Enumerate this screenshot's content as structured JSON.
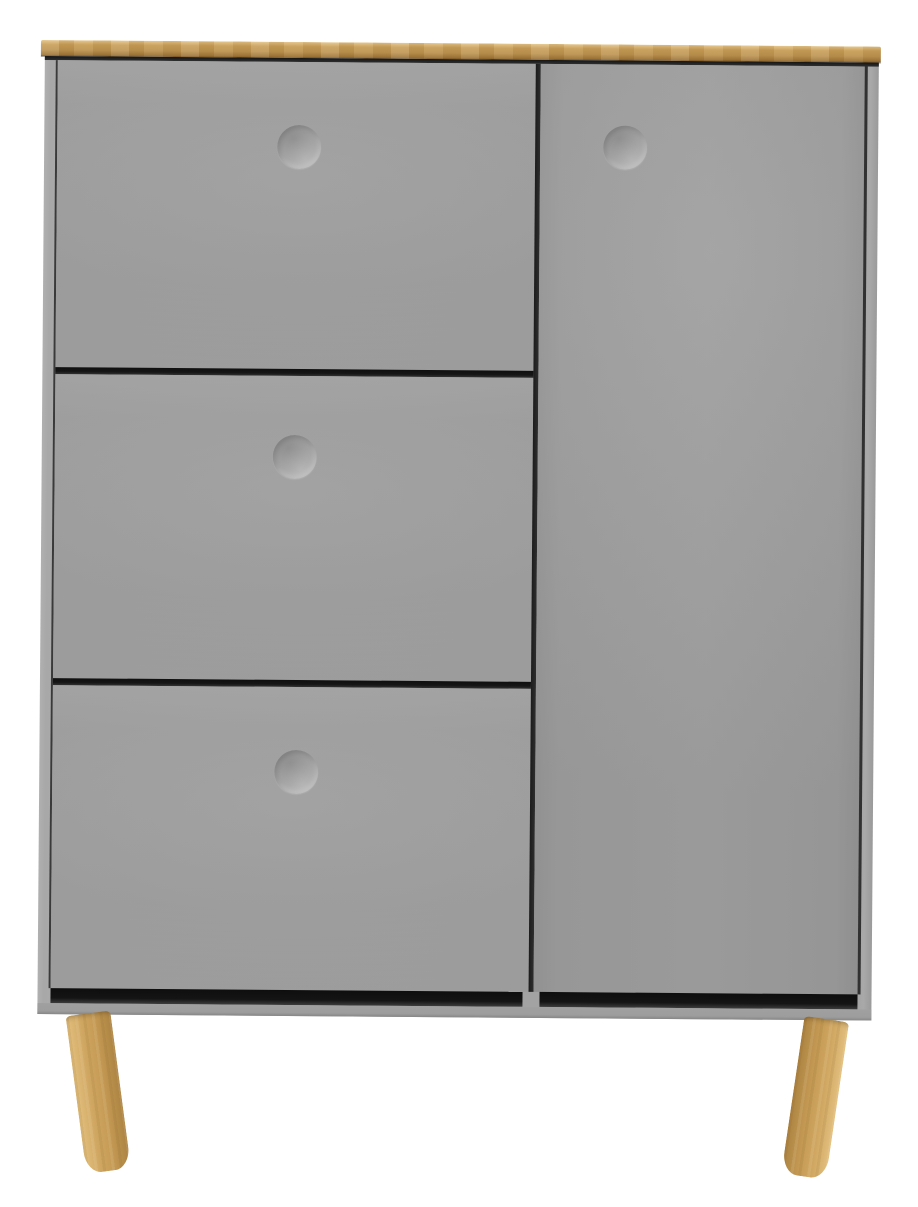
{
  "scene": {
    "description": "Product photograph of a grey Scandinavian-style highboard cabinet with a light oak top board, three drawer fronts on the left, one tall door on the right, four recessed circular handles and two splayed light oak legs, on a plain white background",
    "text_content": "none"
  },
  "colors": {
    "background": "#ffffff",
    "cabinet-grey": "#9e9e9e",
    "cabinet-side-grey": "#a9a9a9",
    "base-grey": "#a0a0a0",
    "gap-dark": "#161616",
    "oak-light": "#e4c488",
    "oak-mid": "#c89e58",
    "oak-dark": "#9d7437",
    "oak-leg-light": "#e2bf7e",
    "oak-leg-mid": "#d0a762",
    "oak-leg-dark": "#ad8342"
  },
  "cabinet": {
    "top_board_material": "oak",
    "left_column_fronts": [
      "top drawer front",
      "middle drawer front",
      "bottom drawer front"
    ],
    "right_section": "tall hinged door",
    "handle_style": "recessed circle, pressed into front",
    "handle_count": 4,
    "leg_count_visible": 2,
    "leg_style": "round tapered, splayed outward"
  }
}
